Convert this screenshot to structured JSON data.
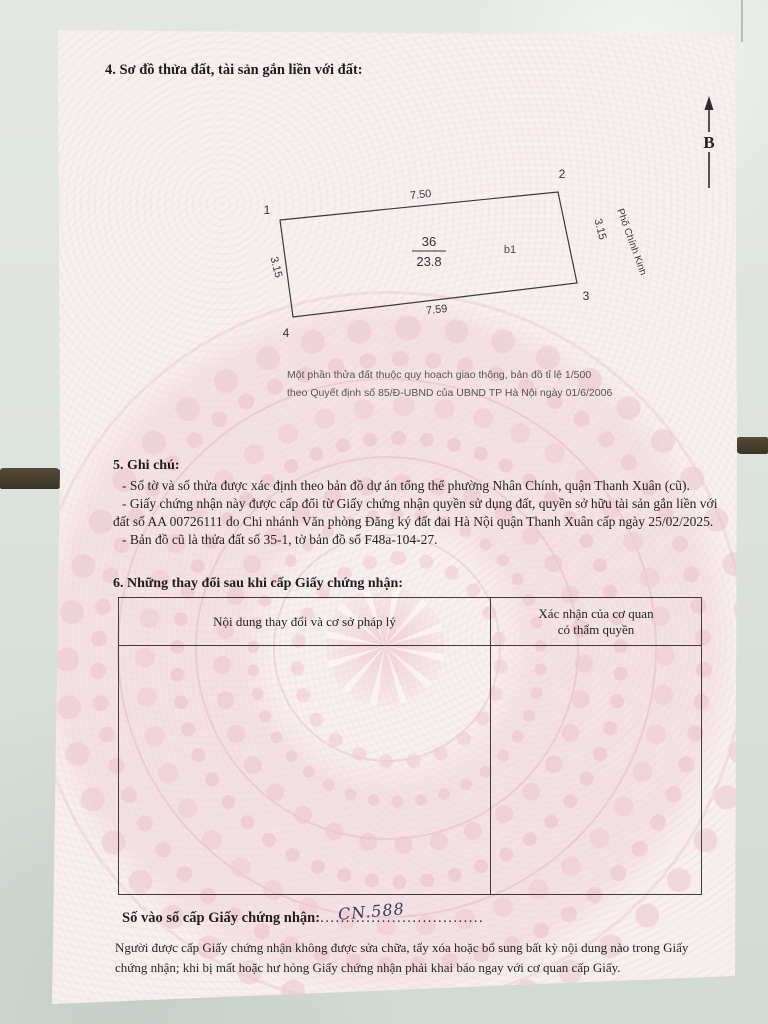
{
  "colors": {
    "paper": "#f7f0f0",
    "pattern_pink": "#e9c3cb",
    "tile": "#dde3dc",
    "grout": "#46402f",
    "ink": "#222222",
    "handwriting_ink": "#33405c"
  },
  "page": {
    "section4_title": "4. Sơ đồ thửa đất, tài sản gắn liền với đất:",
    "north_label": "B",
    "street_label": "Phố Chính Kinh",
    "plot": {
      "corner1": "1",
      "corner2": "2",
      "corner3": "3",
      "corner4": "4",
      "top_length": "7.50",
      "bottom_length": "7.59",
      "left_length": "3.15",
      "right_length": "3.15",
      "plot_number": "36",
      "area": "23.8",
      "sub_label": "b1"
    },
    "map_note_line1": "Một phần thửa đất thuộc quy hoạch giao thông, bản đồ tỉ lệ 1/500",
    "map_note_line2": "theo Quyết định số 85/Đ-UBND của UBND TP Hà Nội ngày 01/6/2006",
    "section5_title": "5. Ghi chú:",
    "notes": [
      "- Số tờ và số thửa được xác định theo bản đồ dự án tổng thể phường Nhân Chính, quận Thanh Xuân (cũ).",
      "- Giấy chứng nhận này được cấp đổi từ Giấy chứng nhận quyền sử dụng đất, quyền sở hữu tài sản gắn liền với đất số AA 00726111 do Chi nhánh Văn phòng Đăng ký đất đai Hà Nội quận Thanh Xuân cấp ngày 25/02/2025.",
      "- Bản đồ cũ là thửa đất số 35-1, tờ bản đồ số F48a-104-27."
    ],
    "section6_title": "6. Những thay đổi sau khi cấp Giấy chứng nhận:",
    "table": {
      "col1_header": "Nội dung thay đổi và cơ sở pháp lý",
      "col2_header_line1": "Xác nhận của cơ quan",
      "col2_header_line2": "có thẩm quyền"
    },
    "registry_label": "Số vào sổ cấp Giấy chứng nhận:",
    "registry_number": "CN.588",
    "registry_dots": "................................",
    "footer_text": "Người được cấp Giấy chứng nhận không được sửa chữa, tẩy xóa hoặc bổ sung bất kỳ nội dung nào trong Giấy chứng nhận; khi bị mất hoặc hư hỏng Giấy chứng nhận phải khai báo ngay với cơ quan cấp Giấy."
  }
}
